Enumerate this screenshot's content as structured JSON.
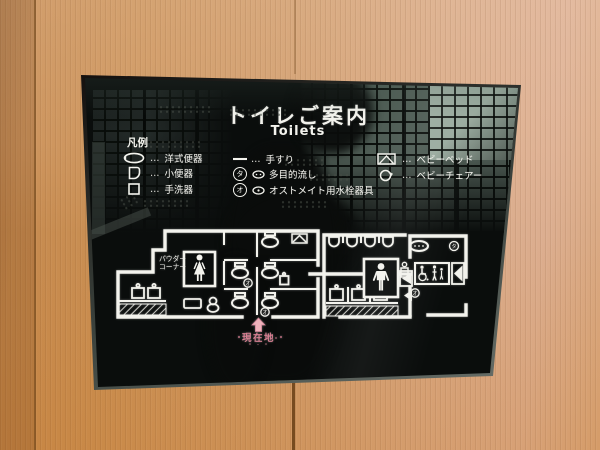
{
  "sign": {
    "title": "トイレご案内",
    "subtitle": "Toilets",
    "legend": {
      "heading": "凡例",
      "columns": [
        {
          "items": [
            {
              "icon": "western-toilet-icon",
              "dots": "…",
              "label": "洋式便器"
            },
            {
              "icon": "urinal-icon",
              "dots": "…",
              "label": "小便器"
            },
            {
              "icon": "hand-washbasin-icon",
              "dots": "…",
              "label": "手洗器"
            }
          ]
        },
        {
          "items": [
            {
              "icon": "handrail-icon",
              "dots": "…",
              "label": "手すり"
            },
            {
              "icon": "multipurpose-sink-icon",
              "badge": "タ",
              "label": "多目的流し"
            },
            {
              "icon": "ostomate-fixture-icon",
              "badge": "オ",
              "label": "オストメイト用水栓器具"
            }
          ]
        },
        {
          "items": [
            {
              "icon": "baby-bed-icon",
              "dots": "…",
              "label": "ベビーベッド"
            },
            {
              "icon": "baby-chair-icon",
              "dots": "…",
              "label": "ベビーチェアー"
            }
          ]
        }
      ]
    },
    "map": {
      "powder_corner_line1": "パウダー",
      "powder_corner_line2": "コーナー",
      "current_location": "現在地",
      "badge_ta": "タ",
      "badge_o": "オ",
      "icons": [
        "woman-pictogram",
        "man-pictogram",
        "wheelchair-pictogram",
        "parent-and-child-pictogram",
        "toilet-symbol",
        "urinal-symbol",
        "washbasin-symbol",
        "baby-bed-symbol",
        "door-symbol",
        "current-location-arrow"
      ]
    },
    "colors": {
      "print": "#f3f3ed",
      "current_location_pink": "#d97f92",
      "glass": "#0a0d0c",
      "reflection_green": "#4e5c54"
    }
  },
  "wall": {
    "colors": {
      "wood_left": "#c68a4e",
      "wood_right_top": "#dcae90",
      "wood_bottom": "#cf9147",
      "seam": "#6d451a"
    }
  }
}
